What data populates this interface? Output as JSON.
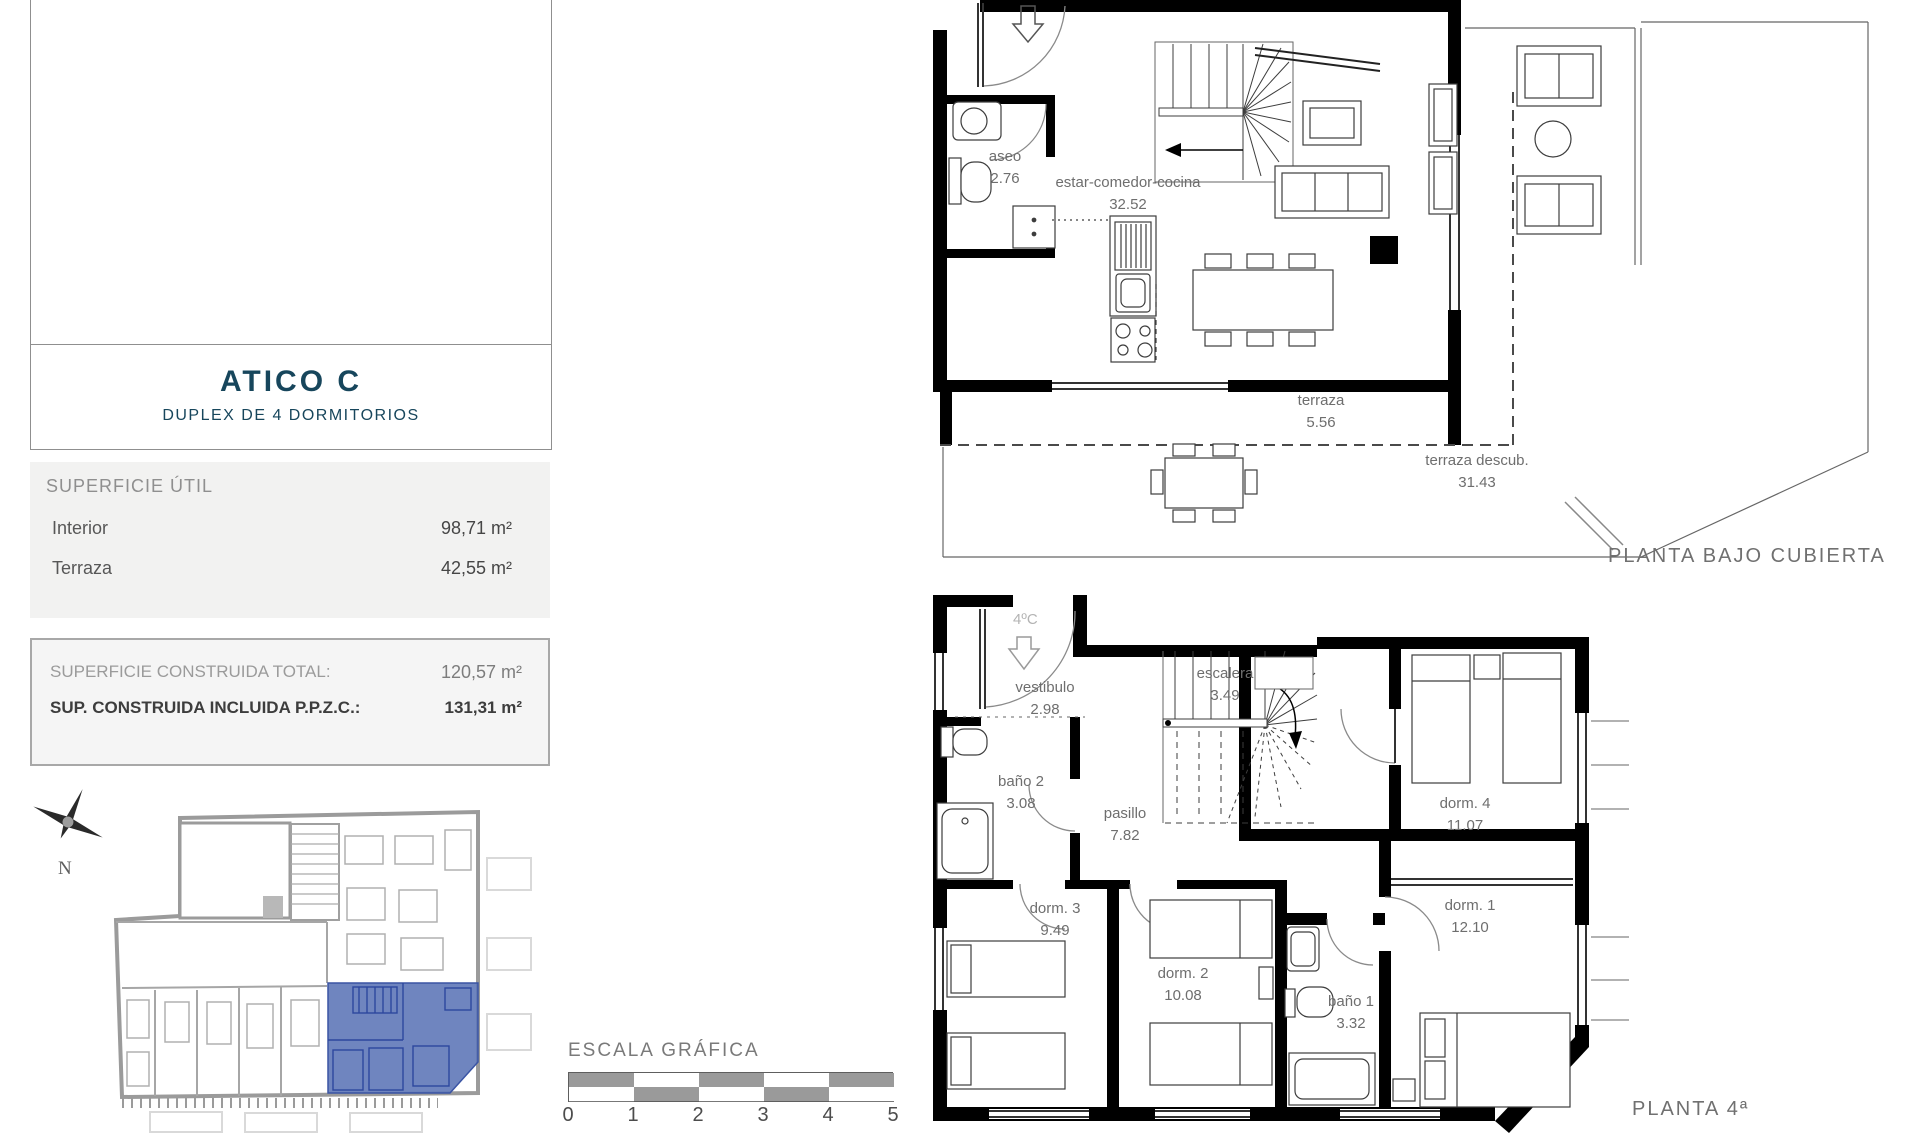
{
  "sidebar": {
    "title": "ATICO C",
    "subtitle": "DUPLEX DE 4 DORMITORIOS",
    "superficie_util": {
      "heading": "SUPERFICIE ÚTIL",
      "rows": [
        {
          "label": "Interior",
          "value": "98,71 m²"
        },
        {
          "label": "Terraza",
          "value": "42,55 m²"
        }
      ]
    },
    "construida": {
      "row1_label": "SUPERFICIE CONSTRUIDA TOTAL:",
      "row1_value": "120,57 m²",
      "row2_label": "SUP. CONSTRUIDA INCLUIDA P.P.Z.C.:",
      "row2_value": "131,31 m²"
    },
    "compass_letter": "N"
  },
  "scalebar": {
    "title": "ESCALA GRÁFICA",
    "ticks": [
      "0",
      "1",
      "2",
      "3",
      "4",
      "5"
    ]
  },
  "plans": {
    "upper": {
      "title": "PLANTA BAJO CUBIERTA",
      "rooms": [
        {
          "label": "aseo",
          "area": "2.76"
        },
        {
          "label": "estar-comedor-cocina",
          "area": "32.52"
        },
        {
          "label": "terraza",
          "area": "5.56"
        },
        {
          "label": "terraza descub.",
          "area": "31.43"
        }
      ]
    },
    "lower": {
      "title": "PLANTA 4ª",
      "entry_label": "4ºC",
      "rooms": [
        {
          "label": "vestibulo",
          "area": "2.98"
        },
        {
          "label": "escalera",
          "area": "3.49"
        },
        {
          "label": "baño 2",
          "area": "3.08"
        },
        {
          "label": "pasillo",
          "area": "7.82"
        },
        {
          "label": "dorm. 3",
          "area": "9.49"
        },
        {
          "label": "dorm. 2",
          "area": "10.08"
        },
        {
          "label": "baño 1",
          "area": "3.32"
        },
        {
          "label": "dorm. 1",
          "area": "12.10"
        },
        {
          "label": "dorm. 4",
          "area": "11.07"
        }
      ]
    }
  },
  "colors": {
    "accent_blue": "#5b74b6",
    "title_teal": "#17465c",
    "plan_gray": "#9b9b9b"
  }
}
